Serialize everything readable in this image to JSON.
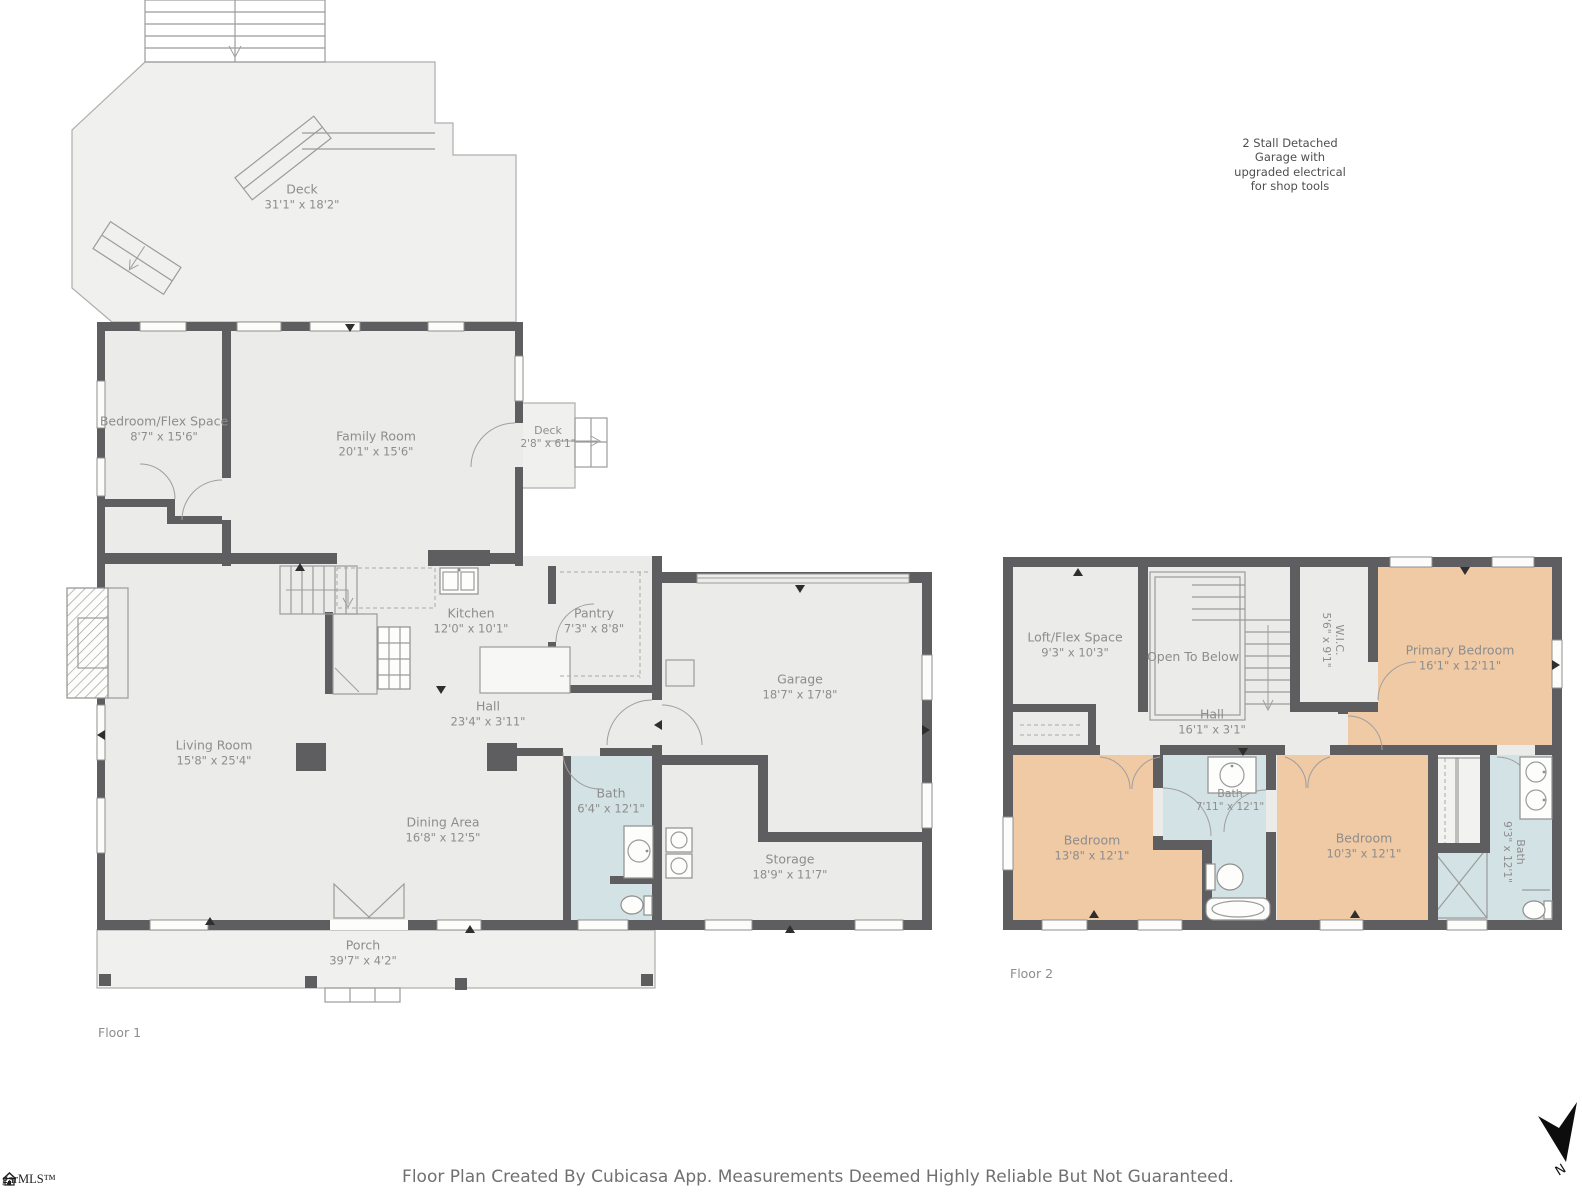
{
  "floors": {
    "floor1": {
      "label": "Floor 1",
      "rooms": {
        "deck": {
          "name": "Deck",
          "dims": "31'1\" x 18'2\""
        },
        "bedroom_flex": {
          "name": "Bedroom/Flex Space",
          "dims": "8'7\" x 15'6\""
        },
        "family_room": {
          "name": "Family Room",
          "dims": "20'1\" x 15'6\""
        },
        "deck_small": {
          "name": "Deck",
          "dims": "2'8\" x 6'1\""
        },
        "kitchen": {
          "name": "Kitchen",
          "dims": "12'0\" x 10'1\""
        },
        "pantry": {
          "name": "Pantry",
          "dims": "7'3\" x 8'8\""
        },
        "hall": {
          "name": "Hall",
          "dims": "23'4\" x 3'11\""
        },
        "living_room": {
          "name": "Living Room",
          "dims": "15'8\" x 25'4\""
        },
        "dining_area": {
          "name": "Dining Area",
          "dims": "16'8\" x 12'5\""
        },
        "bath": {
          "name": "Bath",
          "dims": "6'4\" x 12'1\""
        },
        "garage": {
          "name": "Garage",
          "dims": "18'7\" x 17'8\""
        },
        "storage": {
          "name": "Storage",
          "dims": "18'9\" x 11'7\""
        },
        "porch": {
          "name": "Porch",
          "dims": "39'7\" x 4'2\""
        }
      }
    },
    "floor2": {
      "label": "Floor 2",
      "rooms": {
        "loft_flex": {
          "name": "Loft/Flex Space",
          "dims": "9'3\" x 10'3\""
        },
        "open_to_below": {
          "name": "Open To Below"
        },
        "wic": {
          "name": "W.I.C.",
          "dims": "5'6\" x 9'1\""
        },
        "primary_bedroom": {
          "name": "Primary Bedroom",
          "dims": "16'1\" x 12'11\""
        },
        "hall": {
          "name": "Hall",
          "dims": "16'1\" x 3'1\""
        },
        "bedroom_left": {
          "name": "Bedroom",
          "dims": "13'8\" x 12'1\""
        },
        "bath_middle": {
          "name": "Bath",
          "dims": "7'11\" x 12'1\""
        },
        "bedroom_right": {
          "name": "Bedroom",
          "dims": "10'3\" x 12'1\""
        },
        "bath_right": {
          "name": "Bath",
          "dims": "9'3\" x 12'1\""
        }
      }
    }
  },
  "annotations": {
    "garage_note": "2 Stall Detached\nGarage with\nupgraded electrical\nfor shop tools"
  },
  "footer": {
    "disclaimer": "Floor Plan Created By Cubicasa App. Measurements Deemed Highly Reliable But Not Guaranteed."
  },
  "branding": {
    "mls_logo_text": "garMLS™"
  },
  "compass": {
    "north_label": "N"
  },
  "colors": {
    "wall": "#5e5e60",
    "floor": "#ebebe9",
    "deck": "#f0f0ee",
    "bath": "#d3e2e4",
    "bedroom": "#f0c9a5",
    "label_text": "#8d8d8d"
  }
}
